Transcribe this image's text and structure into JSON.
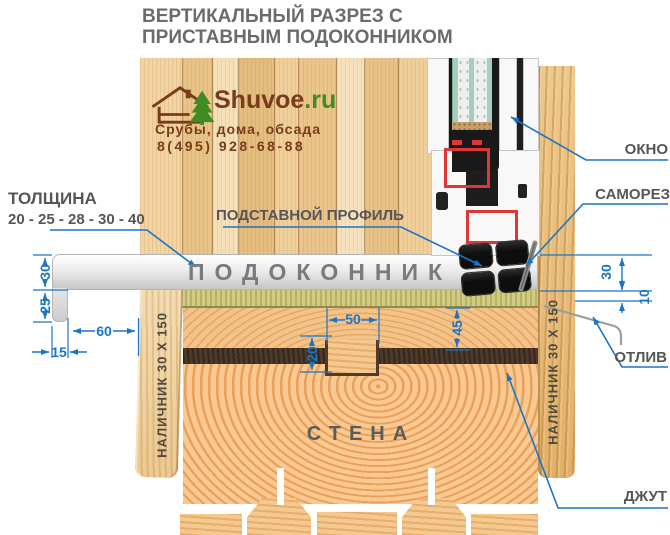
{
  "title": {
    "line1": "ВЕРТИКАЛЬНЫЙ РАЗРЕЗ С",
    "line2": "ПРИСТАВНЫМ ПОДОКОННИКОМ"
  },
  "logo": {
    "brand": "Shuvoe",
    "tld": ".ru",
    "tagline": "Срубы, дома, обсада",
    "phone": "8(495) 928-68-88"
  },
  "callouts": {
    "thickness_title": "ТОЛЩИНА",
    "thickness_values": "20 - 25 - 28 - 30 - 40",
    "support_profile": "ПОДСТАВНОЙ ПРОФИЛЬ",
    "windowsill": "ПОДОКОННИК",
    "window": "ОКНО",
    "screw": "САМОРЕЗ",
    "drip": "ОТЛИВ",
    "jute": "ДЖУТ",
    "wall": "СТЕНА",
    "casing_left": "НАЛИЧНИК 30 Х 150",
    "casing_right": "НАЛИЧНИК 30 Х 150"
  },
  "dimensions": {
    "sill_thickness": "30",
    "front_drop": "25",
    "overhang": "60",
    "lip": "15",
    "tenon_width": "50",
    "tenon_depth": "20",
    "beam_height": "45",
    "right_height": "30",
    "drip_offset": "10"
  },
  "colors": {
    "dimension_blue": "#1b75c6",
    "label_gray": "#565656",
    "brand_brown": "#7a3b1c",
    "brand_green": "#3f8d22",
    "reinforcement_red": "#e03636"
  }
}
